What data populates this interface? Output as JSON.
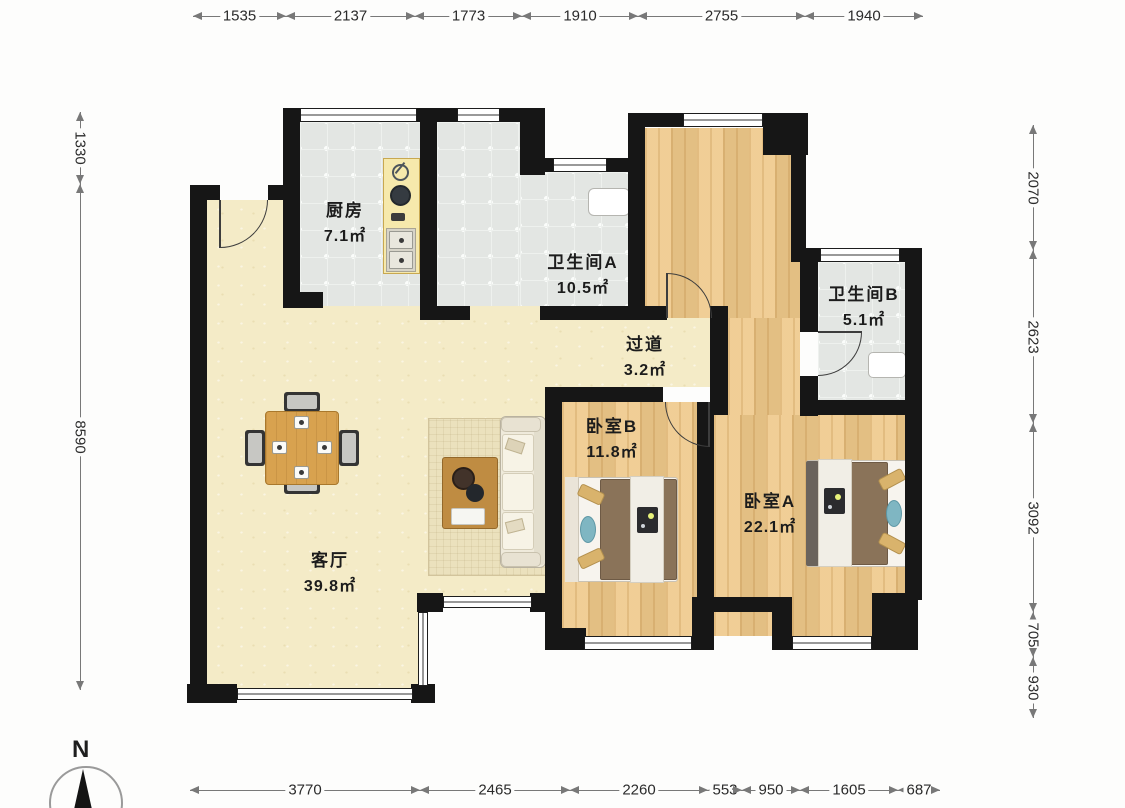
{
  "plan_title": "residential floor plan",
  "rooms": [
    {
      "id": "kitchen",
      "name": "厨房",
      "area": "7.1㎡"
    },
    {
      "id": "bathroom-a",
      "name": "卫生间A",
      "area": "10.5㎡"
    },
    {
      "id": "bathroom-b",
      "name": "卫生间B",
      "area": "5.1㎡"
    },
    {
      "id": "hallway",
      "name": "过道",
      "area": "3.2㎡"
    },
    {
      "id": "bedroom-b",
      "name": "卧室B",
      "area": "11.8㎡"
    },
    {
      "id": "bedroom-a",
      "name": "卧室A",
      "area": "22.1㎡"
    },
    {
      "id": "living-room",
      "name": "客厅",
      "area": "39.8㎡"
    }
  ],
  "dimensions": {
    "top": [
      "1535",
      "2137",
      "1773",
      "1910",
      "2755",
      "1940"
    ],
    "bottom": [
      "3770",
      "2465",
      "2260",
      "553",
      "950",
      "1605",
      "687"
    ],
    "left": [
      "1330",
      "8590"
    ],
    "right": [
      "2070",
      "2623",
      "3092",
      "705",
      "930"
    ]
  },
  "compass": {
    "label": "N"
  },
  "palette": {
    "wall": "#161616",
    "floor_living": "#f4ebc7",
    "floor_wood": "#efc98a",
    "floor_tile": "#e3e6e3",
    "bed_blanket": "#8a7359",
    "pillow_tan": "#d9b36c",
    "cushion_teal": "#7fb6c2",
    "table_wood": "#d8a24f",
    "counter_yellow": "#f6e9ac"
  }
}
